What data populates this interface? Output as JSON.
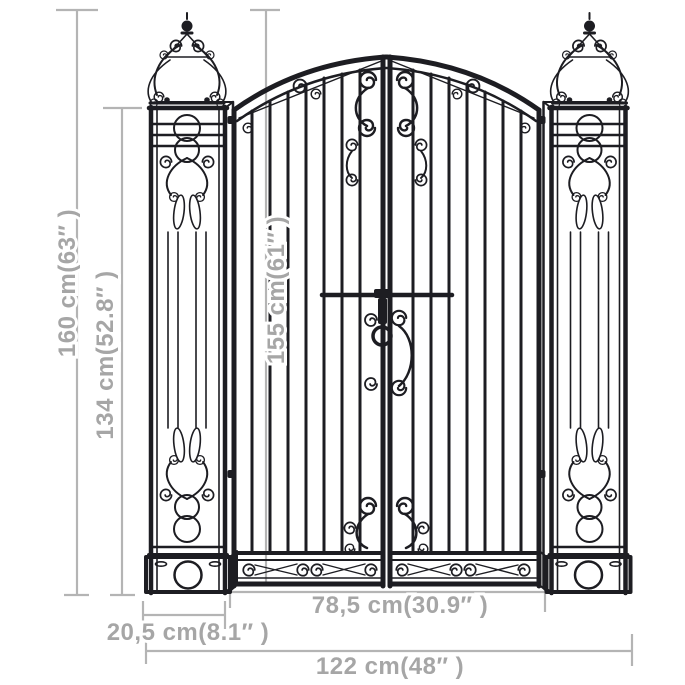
{
  "canvas": {
    "width": 685,
    "height": 685,
    "background": "#ffffff"
  },
  "colors": {
    "iron": "#1d1d22",
    "dimension_lines": "#b4b4b4",
    "dimension_labels": "#a6a6a6"
  },
  "dimensions": {
    "total_height": {
      "label": "160 cm(63″ )",
      "cm": 160,
      "inch": 63
    },
    "frame_height": {
      "label": "134 cm(52.8″ )",
      "cm": 134,
      "inch": 52.8
    },
    "gate_height": {
      "label": "155 cm(61″ )",
      "cm": 155,
      "inch": 61
    },
    "gate_width": {
      "label": "78,5 cm(30.9″ )",
      "cm": 78.5,
      "inch": 30.9
    },
    "pillar_width": {
      "label": "20,5 cm(8.1″ )",
      "cm": 20.5,
      "inch": 8.1
    },
    "total_width": {
      "label": "122 cm(48″ )",
      "cm": 122,
      "inch": 48
    }
  }
}
